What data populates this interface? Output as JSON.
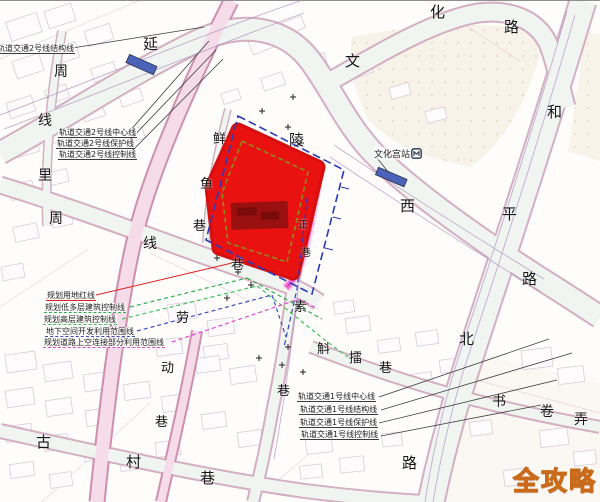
{
  "colors": {
    "site_red": "#ea1111",
    "site_red_rim": "#d40f0f",
    "site_core_dark": "#8e0f0f",
    "site_inner_dash": "#8c8c1e",
    "boundary_blue": "#2a3ab8",
    "boundary_magenta": "#e64ad0",
    "planning_red_line": "#e02020",
    "planning_green": "#2fae4a",
    "planning_green2": "#3fc45a",
    "planning_blue": "#3a4fc0",
    "planning_magenta": "#e246d2",
    "station_blue": "#4a62b8",
    "watermark_gold": "#f5a62c",
    "watermark_outline": "#c96a1a"
  },
  "watermark": {
    "text": "全攻略"
  },
  "station_label": {
    "text": "文化宫站"
  },
  "street_labels": [
    {
      "t": "延",
      "x": 143,
      "y": 36,
      "s": 15
    },
    {
      "t": "陵",
      "x": 289,
      "y": 132,
      "s": 15
    },
    {
      "t": "西",
      "x": 400,
      "y": 198,
      "s": 15
    },
    {
      "t": "路",
      "x": 522,
      "y": 271,
      "s": 15
    },
    {
      "t": "文",
      "x": 345,
      "y": 53,
      "s": 15
    },
    {
      "t": "化",
      "x": 430,
      "y": 4,
      "s": 15
    },
    {
      "t": "路",
      "x": 504,
      "y": 19,
      "s": 15
    },
    {
      "t": "和",
      "x": 547,
      "y": 104,
      "s": 15
    },
    {
      "t": "平",
      "x": 502,
      "y": 206,
      "s": 15
    },
    {
      "t": "北",
      "x": 459,
      "y": 331,
      "s": 15
    },
    {
      "t": "路",
      "x": 402,
      "y": 455,
      "s": 15
    },
    {
      "t": "周",
      "x": 54,
      "y": 64,
      "s": 14
    },
    {
      "t": "线",
      "x": 38,
      "y": 113,
      "s": 14
    },
    {
      "t": "里",
      "x": 38,
      "y": 168,
      "s": 14
    },
    {
      "t": "周",
      "x": 49,
      "y": 211,
      "s": 14
    },
    {
      "t": "线",
      "x": 143,
      "y": 236,
      "s": 14
    },
    {
      "t": "鲜",
      "x": 213,
      "y": 132,
      "s": 13
    },
    {
      "t": "鱼",
      "x": 200,
      "y": 177,
      "s": 13
    },
    {
      "t": "巷",
      "x": 193,
      "y": 219,
      "s": 13
    },
    {
      "t": "巷",
      "x": 231,
      "y": 258,
      "s": 13
    },
    {
      "t": "正",
      "x": 298,
      "y": 220,
      "s": 10
    },
    {
      "t": "巷",
      "x": 301,
      "y": 248,
      "s": 10
    },
    {
      "t": "素",
      "x": 294,
      "y": 300,
      "s": 13
    },
    {
      "t": "斛",
      "x": 317,
      "y": 342,
      "s": 13
    },
    {
      "t": "擂",
      "x": 349,
      "y": 351,
      "s": 13
    },
    {
      "t": "巷",
      "x": 379,
      "y": 361,
      "s": 13
    },
    {
      "t": "巷",
      "x": 277,
      "y": 384,
      "s": 13
    },
    {
      "t": "劳",
      "x": 176,
      "y": 311,
      "s": 13
    },
    {
      "t": "动",
      "x": 161,
      "y": 361,
      "s": 13
    },
    {
      "t": "巷",
      "x": 155,
      "y": 415,
      "s": 13
    },
    {
      "t": "古",
      "x": 36,
      "y": 434,
      "s": 15
    },
    {
      "t": "村",
      "x": 126,
      "y": 454,
      "s": 15
    },
    {
      "t": "巷",
      "x": 200,
      "y": 470,
      "s": 15
    },
    {
      "t": "书",
      "x": 492,
      "y": 394,
      "s": 14
    },
    {
      "t": "卷",
      "x": 540,
      "y": 404,
      "s": 14
    },
    {
      "t": "弄",
      "x": 574,
      "y": 412,
      "s": 14
    }
  ],
  "rail2_labels": [
    {
      "t": "轨道交通2号线结构线",
      "x": -4,
      "y": 43
    },
    {
      "t": "轨道交通2号线中心线",
      "x": 58,
      "y": 127
    },
    {
      "t": "轨道交通2号线保护线",
      "x": 56,
      "y": 138
    },
    {
      "t": "轨道交通2号线控制线",
      "x": 58,
      "y": 149
    }
  ],
  "planning_labels": [
    {
      "t": "规划用地红线",
      "x": 46,
      "y": 290,
      "line_color": "#e02020",
      "line_style": "solid"
    },
    {
      "t": "规划低多层建筑控制线",
      "x": 44,
      "y": 302,
      "line_color": "#2fae4a",
      "line_style": "dashed"
    },
    {
      "t": "规划高层建筑控制线",
      "x": 43,
      "y": 314,
      "line_color": "#3fc45a",
      "line_style": "dashed"
    },
    {
      "t": "地下空间开发利用范围线",
      "x": 45,
      "y": 326,
      "line_color": "#3a4fc0",
      "line_style": "dashed"
    },
    {
      "t": "规划道路上空连接部分利用范围线",
      "x": 43,
      "y": 337,
      "line_color": "#e246d2",
      "line_style": "dashed"
    }
  ],
  "rail1_labels": [
    {
      "t": "轨道交通1号线中心线",
      "x": 297,
      "y": 391
    },
    {
      "t": "轨道交通1号线结构线",
      "x": 299,
      "y": 404
    },
    {
      "t": "轨道交通1号线保护线",
      "x": 299,
      "y": 417
    },
    {
      "t": "轨道交通1号线控制线",
      "x": 300,
      "y": 429
    }
  ]
}
